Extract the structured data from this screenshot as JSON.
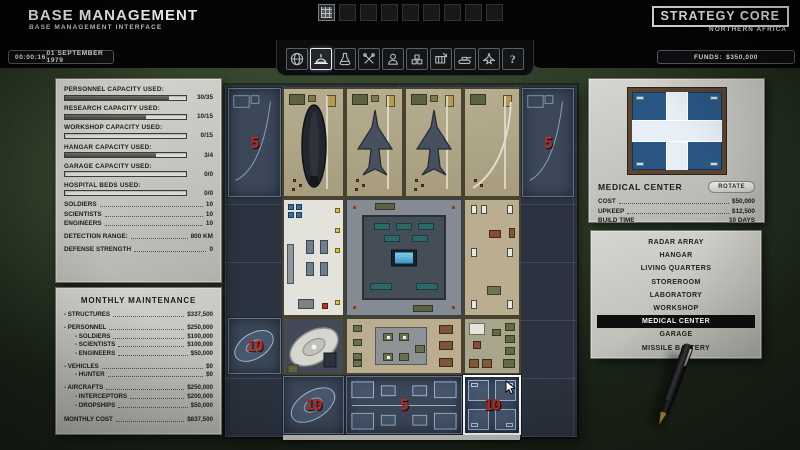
{
  "header": {
    "title": "BASE MANAGEMENT",
    "subtitle": "BASE MANAGEMENT INTERFACE",
    "corner_label": "STRATEGY CORE",
    "region": "NORTHERN AFRICA",
    "clock": "00:00:16",
    "date": "01 SEPTEMBER 1979",
    "funds_label": "FUNDS:",
    "funds_value": "$350,000"
  },
  "toolbar": {
    "items": [
      {
        "id": "geoscape",
        "selected": false
      },
      {
        "id": "base",
        "selected": true
      },
      {
        "id": "research",
        "selected": false
      },
      {
        "id": "workshop",
        "selected": false
      },
      {
        "id": "personnel",
        "selected": false
      },
      {
        "id": "storage",
        "selected": false
      },
      {
        "id": "transfer",
        "selected": false
      },
      {
        "id": "vehicles",
        "selected": false
      },
      {
        "id": "aircraft",
        "selected": false
      },
      {
        "id": "help",
        "selected": false
      }
    ]
  },
  "stats": {
    "capacities": [
      {
        "label": "PERSONNEL CAPACITY USED:",
        "value": "30/35",
        "pct": 86
      },
      {
        "label": "RESEARCH CAPACITY USED:",
        "value": "10/15",
        "pct": 67
      },
      {
        "label": "WORKSHOP CAPACITY USED:",
        "value": "0/15",
        "pct": 0
      },
      {
        "label": "HANGAR CAPACITY USED:",
        "value": "3/4",
        "pct": 75
      },
      {
        "label": "GARAGE CAPACITY USED:",
        "value": "0/0",
        "pct": 0
      },
      {
        "label": "HOSPITAL BEDS USED:",
        "value": "0/0",
        "pct": 0
      }
    ],
    "roster": [
      {
        "label": "SOLDIERS",
        "value": "10"
      },
      {
        "label": "SCIENTISTS",
        "value": "10"
      },
      {
        "label": "ENGINEERS",
        "value": "10"
      }
    ],
    "detection_label": "DETECTION RANGE:",
    "detection_value": "800 KM",
    "defense_label": "DEFENSE STRENGTH",
    "defense_value": "0"
  },
  "maintenance": {
    "title": "MONTHLY MAINTENANCE",
    "rows": [
      {
        "label": "- STRUCTURES",
        "value": "$337,500"
      },
      {
        "label": "- PERSONNEL",
        "value": "$250,000"
      },
      {
        "label": "- SOLDIERS",
        "value": "$100,000"
      },
      {
        "label": "- SCIENTISTS",
        "value": "$100,000"
      },
      {
        "label": "- ENGINEERS",
        "value": "$50,000"
      },
      {
        "label": "- VEHICLES",
        "value": "$0"
      },
      {
        "label": "- HUNTER",
        "value": "$0"
      },
      {
        "label": "- AIRCRAFTS",
        "value": "$250,000"
      },
      {
        "label": "- INTERCEPTORS",
        "value": "$200,000"
      },
      {
        "label": "- DROPSHIPS",
        "value": "$50,000"
      }
    ],
    "total_label": "MONTHLY COST",
    "total_value": "$837,500"
  },
  "build_info": {
    "name": "MEDICAL CENTER",
    "rotate_label": "ROTATE",
    "rows": [
      {
        "label": "COST",
        "value": "$50,000"
      },
      {
        "label": "UPKEEP",
        "value": "$12,500"
      },
      {
        "label": "BUILD TIME",
        "value": "10 DAYS"
      }
    ]
  },
  "build_list": {
    "items": [
      {
        "label": "RADAR ARRAY",
        "selected": false
      },
      {
        "label": "HANGAR",
        "selected": false
      },
      {
        "label": "LIVING QUARTERS",
        "selected": false
      },
      {
        "label": "STOREROOM",
        "selected": false
      },
      {
        "label": "LABORATORY",
        "selected": false
      },
      {
        "label": "WORKSHOP",
        "selected": false
      },
      {
        "label": "MEDICAL CENTER",
        "selected": true
      },
      {
        "label": "GARAGE",
        "selected": false
      },
      {
        "label": "MISSILE BATTERY",
        "selected": false
      }
    ]
  },
  "base_grid": {
    "construction": {
      "hangar_west_days": "5",
      "hangar_east_days": "5",
      "radar_west_days": "10",
      "radar_south_days": "10",
      "quarters_south_days": "5",
      "medical_placement_days": "10"
    }
  },
  "colors": {
    "accent_red": "#c3281c",
    "felt_green": "#36452e",
    "paper": "#c9c9c3",
    "blueprint": "#3c4859"
  }
}
